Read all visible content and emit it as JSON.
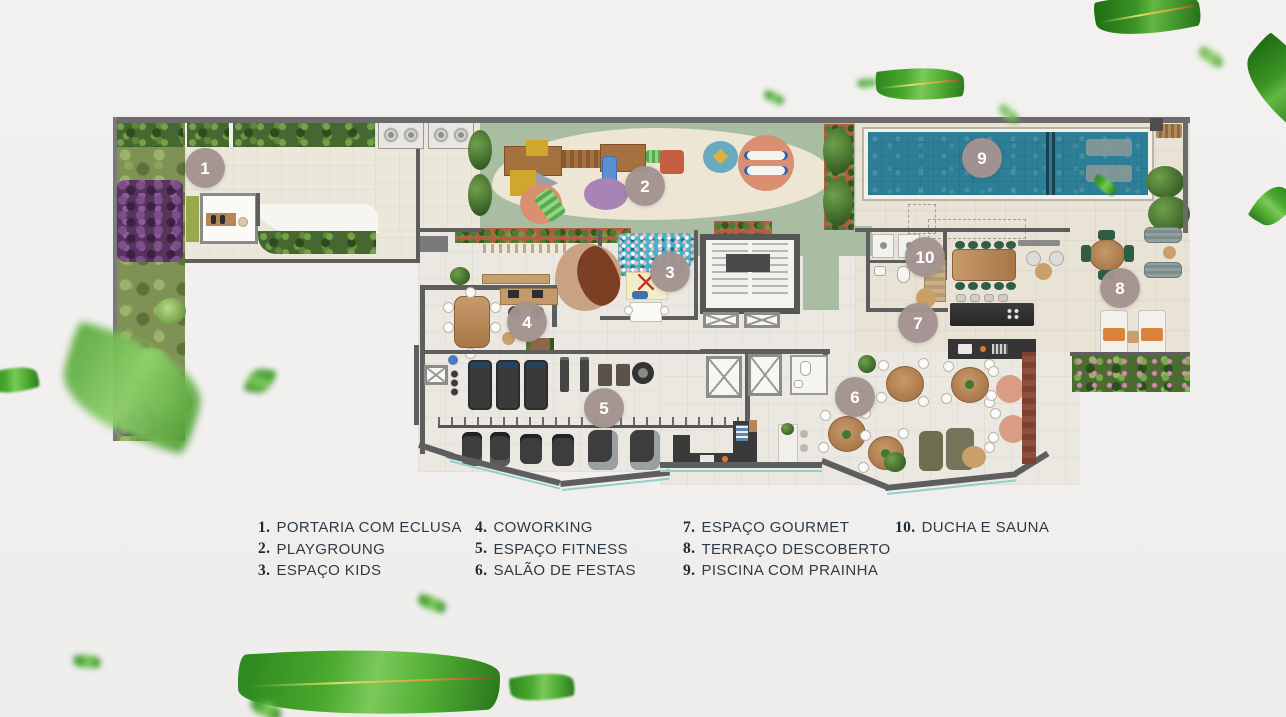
{
  "page": {
    "background_color": "#f1f0ee"
  },
  "plan": {
    "marker_color": "#a39390",
    "pool_color": "#2d7f97",
    "playground_color": "#a9bda2",
    "deck_color": "#e9e3d6",
    "wall_color": "#5e5e5e",
    "markers": [
      {
        "number": "1"
      },
      {
        "number": "2"
      },
      {
        "number": "3"
      },
      {
        "number": "4"
      },
      {
        "number": "5"
      },
      {
        "number": "6"
      },
      {
        "number": "7"
      },
      {
        "number": "8"
      },
      {
        "number": "9"
      },
      {
        "number": "10"
      }
    ]
  },
  "legend": {
    "text_color": "#2e3a45",
    "columns": [
      {
        "items": [
          {
            "number": "1.",
            "label": "PORTARIA COM ECLUSA"
          },
          {
            "number": "2.",
            "label": "PLAYGROUNG"
          },
          {
            "number": "3.",
            "label": "ESPAÇO KIDS"
          }
        ]
      },
      {
        "items": [
          {
            "number": "4.",
            "label": "COWORKING"
          },
          {
            "number": "5.",
            "label": "ESPAÇO FITNESS"
          },
          {
            "number": "6.",
            "label": "SALÃO DE FESTAS"
          }
        ]
      },
      {
        "items": [
          {
            "number": "7.",
            "label": "ESPAÇO GOURMET"
          },
          {
            "number": "8.",
            "label": "TERRAÇO DESCOBERTO"
          },
          {
            "number": "9.",
            "label": "PISCINA COM PRAINHA"
          }
        ]
      },
      {
        "items": [
          {
            "number": "10.",
            "label": "DUCHA E SAUNA"
          }
        ]
      }
    ]
  }
}
